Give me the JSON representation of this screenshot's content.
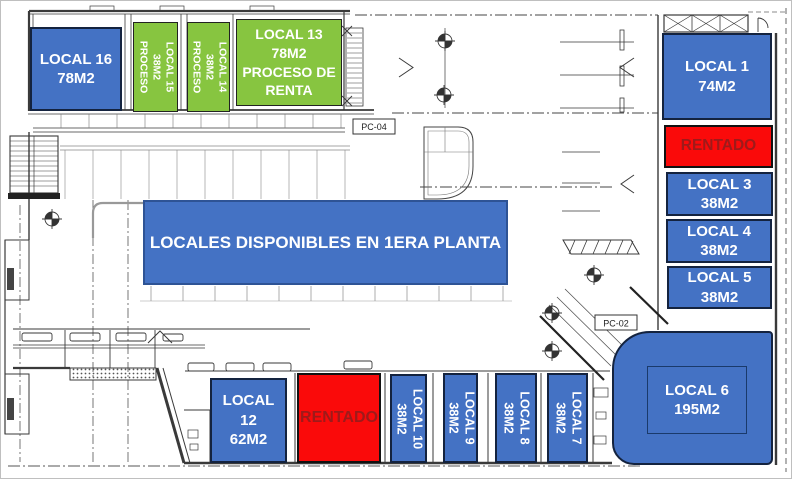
{
  "banner": {
    "title": "LOCALES DISPONIBLES EN 1ERA PLANTA"
  },
  "plan_labels": {
    "pc04": "PC-04",
    "pc02": "PC-02"
  },
  "colors": {
    "available": "#4472C4",
    "in_process": "#87C540",
    "rented": "#FA0A0A",
    "rented_text": "#9E1A1A",
    "box_text": "#FFFFFF"
  },
  "units": {
    "local16": {
      "name": "LOCAL 16",
      "area": "78M2",
      "status": "available"
    },
    "local15": {
      "name": "LOCAL 15",
      "area": "38M2",
      "note": "PROCESO",
      "status": "in_process"
    },
    "local14": {
      "name": "LOCAL 14",
      "area": "38M2",
      "note": "PROCESO",
      "status": "in_process"
    },
    "local13": {
      "name": "LOCAL 13",
      "area": "78M2",
      "note": "PROCESO DE RENTA",
      "status": "in_process"
    },
    "local1": {
      "name": "LOCAL 1",
      "area": "74M2",
      "status": "available"
    },
    "rentado_top": {
      "label": "RENTADO",
      "status": "rented"
    },
    "local3": {
      "name": "LOCAL 3",
      "area": "38M2",
      "status": "available"
    },
    "local4": {
      "name": "LOCAL 4",
      "area": "38M2",
      "status": "available"
    },
    "local5": {
      "name": "LOCAL 5",
      "area": "38M2",
      "status": "available"
    },
    "local6": {
      "name": "LOCAL 6",
      "area": "195M2",
      "status": "available"
    },
    "local12": {
      "name": "LOCAL 12",
      "area": "62M2",
      "status": "available"
    },
    "rentado_bottom": {
      "label": "RENTADO",
      "status": "rented"
    },
    "local10": {
      "name": "LOCAL 10",
      "area": "38M2",
      "status": "available"
    },
    "local9": {
      "name": "LOCAL 9",
      "area": "38M2",
      "status": "available"
    },
    "local8": {
      "name": "LOCAL 8",
      "area": "38M2",
      "status": "available"
    },
    "local7": {
      "name": "LOCAL 7",
      "area": "38M2",
      "status": "available"
    }
  }
}
